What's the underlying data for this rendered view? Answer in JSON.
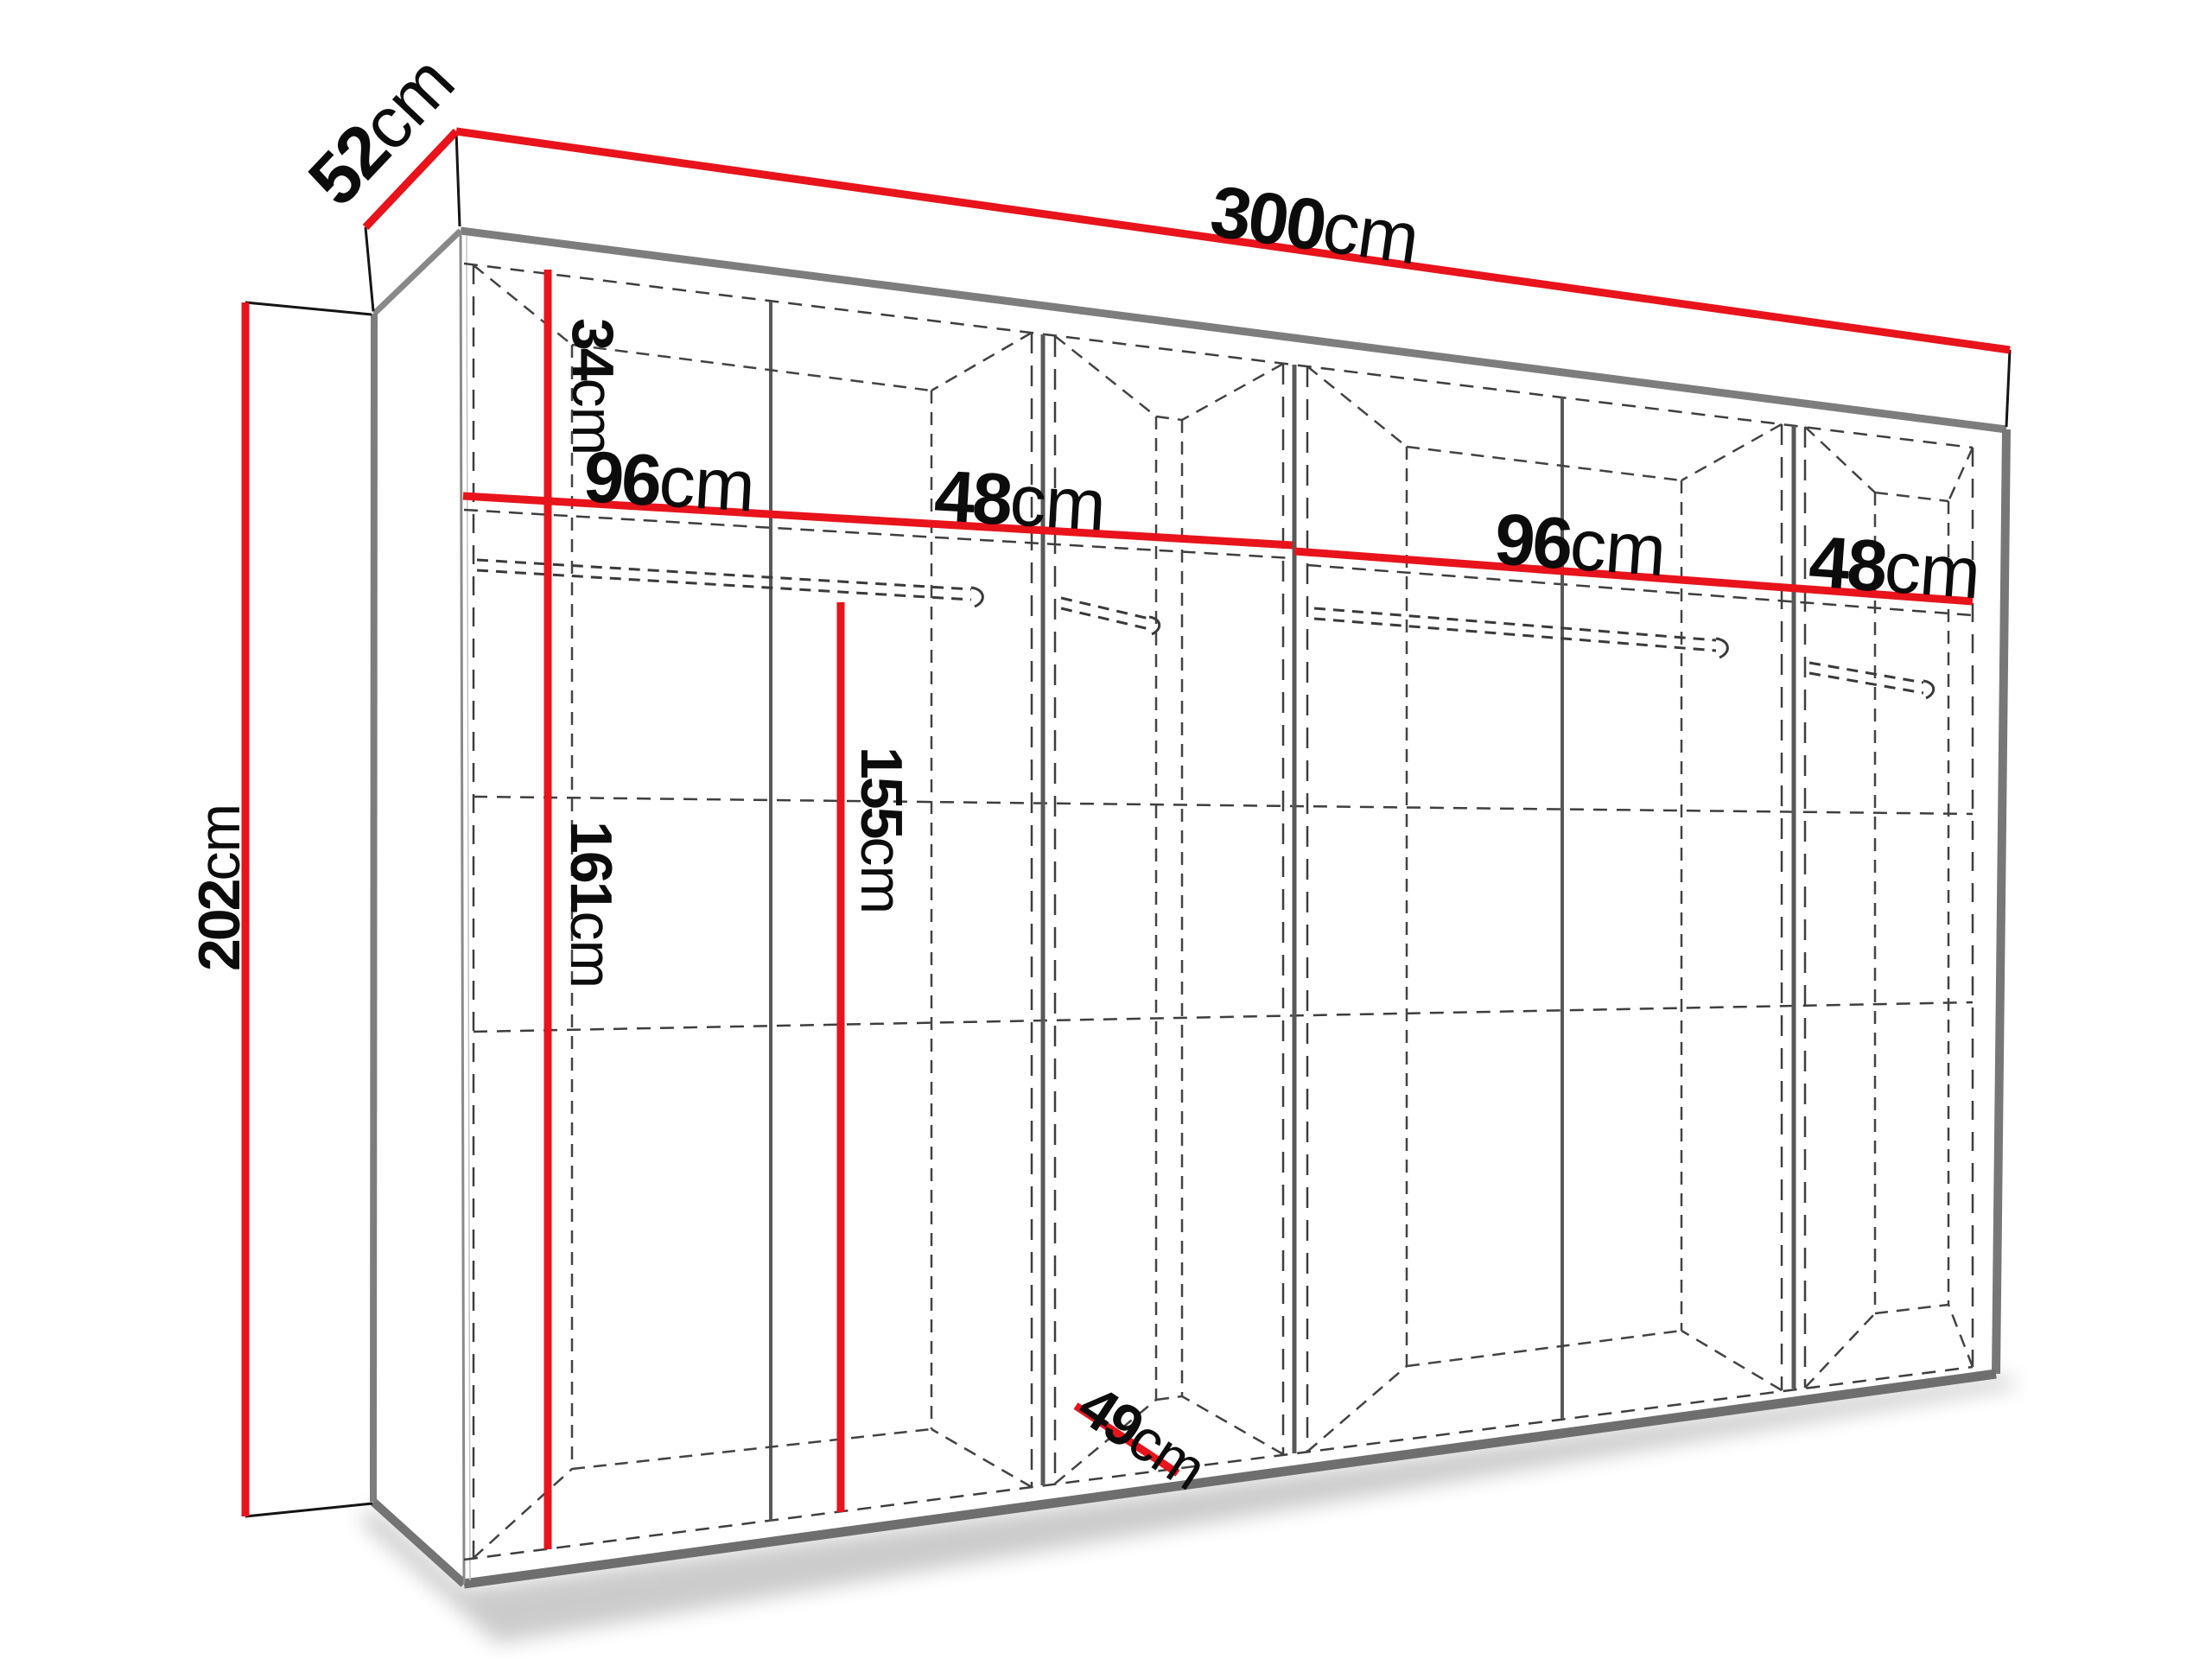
{
  "diagram": {
    "title": "Wardrobe dimension diagram",
    "unit": "cm",
    "colors": {
      "dimension_red": "#e8131b",
      "edge_gray": "#7d7d7d",
      "interior_line": "#3e3e3e",
      "text": "#0c0c0c",
      "background": "#ffffff"
    },
    "dimensions": {
      "width_top": {
        "number": "300",
        "unit": "cm"
      },
      "depth_top": {
        "number": "52",
        "unit": "cm"
      },
      "height_left": {
        "number": "202",
        "unit": "cm"
      },
      "upper_shelf": {
        "number": "34",
        "unit": "cm"
      },
      "bay1_width": {
        "number": "96",
        "unit": "cm"
      },
      "bay2_width": {
        "number": "48",
        "unit": "cm"
      },
      "bay3_width": {
        "number": "96",
        "unit": "cm"
      },
      "bay4_width": {
        "number": "48",
        "unit": "cm"
      },
      "hanging_left": {
        "number": "161",
        "unit": "cm"
      },
      "hanging_center": {
        "number": "155",
        "unit": "cm"
      },
      "interior_depth": {
        "number": "49",
        "unit": "cm"
      }
    }
  }
}
